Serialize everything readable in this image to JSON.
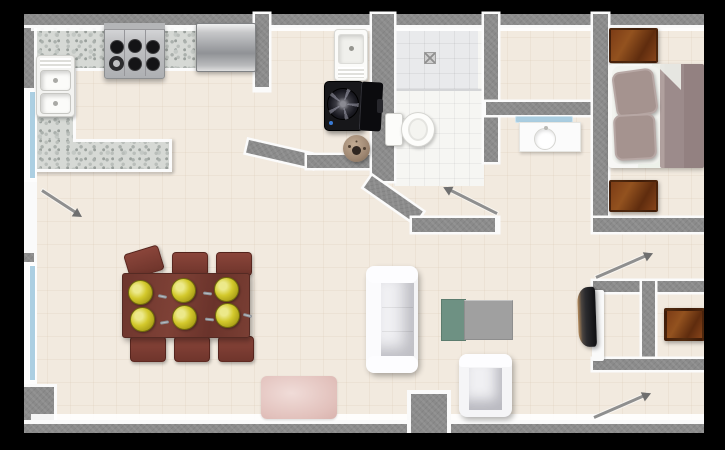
{
  "scene": {
    "type": "apartment-floor-plan",
    "view": "top-down",
    "background": "#000000",
    "note": "rendered floor plan, right edge cropped by viewport"
  },
  "palette": {
    "floor_tile": "#f2eadf",
    "wall": "#8b8b8b",
    "wall_edge": "#fafafa",
    "counter_granite": "#d6d9d5",
    "window_glass": "#accfe2",
    "bath_tile": "#f6f6f3",
    "shower_tile": "#e9eaec",
    "wood_dark": "#6b3414",
    "table_mahogany": "#6d352d",
    "plate_olive": "#d3c92c",
    "bed_mauve": "#9c8b8b",
    "sofa_white": "#f4f4f6",
    "rug_pink": "#e2c1bc",
    "console_green": "#6e9183",
    "console_gray": "#a0a0a0",
    "washer_black": "#17171a"
  },
  "rooms": [
    {
      "name": "kitchen",
      "furniture": [
        "u-shaped-granite-counter",
        "six-burner-stove",
        "refrigerator",
        "double-basin-sink"
      ]
    },
    {
      "name": "laundry-nook",
      "furniture": [
        "utility-sink",
        "washing-machine-lid-open",
        "round-floor-fan"
      ]
    },
    {
      "name": "bathroom",
      "furniture": [
        "shower-with-drain",
        "toilet"
      ]
    },
    {
      "name": "walk-in-closet",
      "furniture": []
    },
    {
      "name": "hallway",
      "furniture": [
        "vanity-with-round-sink"
      ]
    },
    {
      "name": "bedroom",
      "furniture": [
        "double-bed",
        "nightstand-top",
        "nightstand-bottom"
      ]
    },
    {
      "name": "living-dining",
      "furniture": [
        "dining-table",
        "six-chairs",
        "six-place-settings",
        "white-sofa",
        "white-armchair",
        "console-table-green-gray",
        "wall-mounted-tv",
        "pink-rug"
      ]
    },
    {
      "name": "closet-nook",
      "furniture": [
        "dresser"
      ]
    }
  ],
  "doors": [
    {
      "name": "entry-door",
      "wall": "left",
      "swing": "into-living-room"
    },
    {
      "name": "bathroom-door",
      "wall": "hall",
      "swing": "into-hall"
    },
    {
      "name": "bedroom-door",
      "wall": "hall",
      "swing": "up-right"
    },
    {
      "name": "lower-room-door",
      "wall": "bottom-right",
      "swing": "up-right"
    }
  ],
  "windows": [
    {
      "name": "window-upper-left",
      "wall": "left"
    },
    {
      "name": "window-lower-left",
      "wall": "left"
    }
  ]
}
